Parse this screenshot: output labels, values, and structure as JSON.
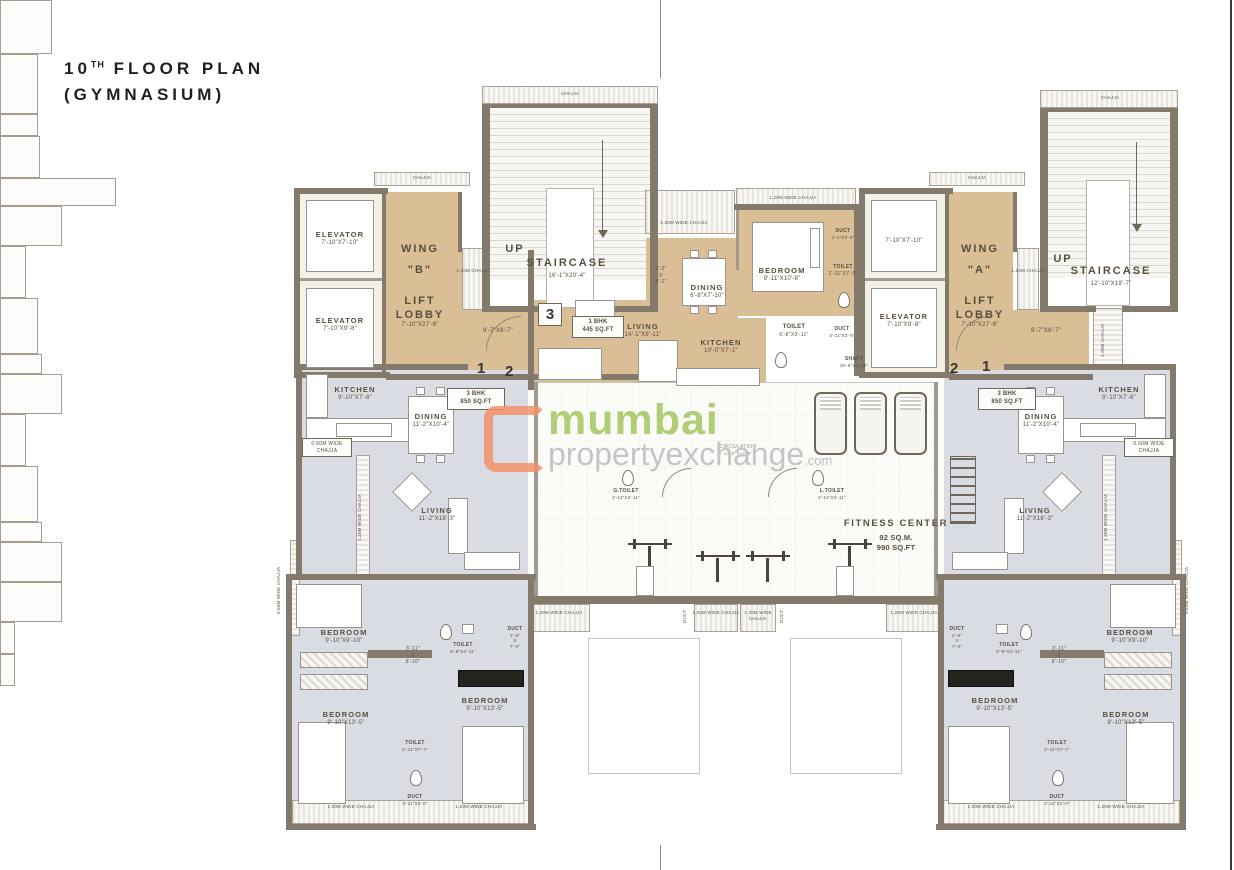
{
  "page": {
    "title_num": "10",
    "title_sup": "TH",
    "title_rest": " FLOOR PLAN",
    "title_line2": "(GYMNASIUM)"
  },
  "watermark": {
    "brand_green": "mumbai",
    "brand_gray": "propertyexchange",
    "brand_suffix": ".com"
  },
  "colors": {
    "lobby_tan": "#d9be96",
    "room_gray": "#d9dde3",
    "wall": "#837a6b",
    "brand_green": "#a5c65f",
    "brand_orange": "#f2916b",
    "brand_gray": "#bcbcbc"
  },
  "common": {
    "chajja": "CHAJJA",
    "chajja_120m": "1.20M CHAJJA",
    "chajja_120_wide": "1.20M WIDE CHAJJA",
    "chajja_060_wide": "0.60M WIDE CHAJJA",
    "duct": "DUCT",
    "toilet": "TOILET",
    "bedroom": "BEDROOM",
    "elevator": "ELEVATOR",
    "kitchen": "KITCHEN",
    "dining": "DINING",
    "living": "LIVING",
    "up": "UP",
    "staircase": "STAIRCASE",
    "lift_lobby": "LIFT LOBBY",
    "shaft": "SHAFT"
  },
  "wing_b": {
    "name1": "WING",
    "name2": "\"B\"",
    "lobby_dims": "7'-10\"X27'-6\"",
    "corridor_dims": "9'-7\"X6'-7\"",
    "elev1_dims": "7'-10\"X7'-10\"",
    "elev2_dims": "7'-10\"X9'-8\"",
    "stair_dims": "16'-1\"X20'-4\"",
    "door_a": "1",
    "door_b": "2"
  },
  "wing_a": {
    "name1": "WING",
    "name2": "\"A\"",
    "lobby_dims": "7'-10\"X27'-6\"",
    "corridor_dims": "9'-7\"X6'-7\"",
    "elev1_dims": "7'-10\"X7'-10\"",
    "elev2_dims": "7'-10\"X9'-8\"",
    "stair_dims": "12'-10\"X19'-7\"",
    "door_a": "2",
    "door_b": "1"
  },
  "unit1": {
    "no": "3",
    "type": "1 BHK",
    "area": "445 SQ.FT",
    "living": "14'-1\"X9'-11\"",
    "dining": "6'-8\"X7'-10\"",
    "pass1": "3'-2\"",
    "pass2": "X",
    "pass3": "8'-1\"",
    "bedroom": "9'-11\"X10'-8\"",
    "kitchen": "10'-0\"X7'-1\"",
    "toilet1": "6'-8\"X3'-11\"",
    "toilet2": "2'-11\"X7'-5\"",
    "duct1": "2'-1\"X2'-9\"",
    "duct2": "3'-11\"X3'-9\"",
    "shaft_dims": "15'-6\"X2'-10\""
  },
  "unit3": {
    "type": "3 BHK",
    "area": "850 SQ.FT",
    "kitchen": "9'-10\"X7'-6\"",
    "dining": "11'-2\"X10'-4\"",
    "living": "11'-2\"X18'-3\"",
    "bed1": "9'-10\"X9'-10\"",
    "bed2": "9'-10\"X13'-5\"",
    "bed3": "9'-10\"X13'-5\"",
    "toilet1": "6'-9\"X4'-11\"",
    "toilet2": "2'-11\"X7'-7\"",
    "duct1a": "2'-8\"",
    "duct1b": "X",
    "duct1c": "7'-3\"",
    "duct2": "3'-11\"X2'-0\"",
    "pass1": "3'-11\"",
    "pass2": "X",
    "pass3": "8'-10\""
  },
  "gym": {
    "name": "FITNESS CENTER",
    "area_m": "92 SQ.M.",
    "area_ft": "990 SQ.FT",
    "gt": "G.TOILET",
    "gt_dims": "4'-11\"X2'-11\"",
    "lt": "L.TOILET",
    "lt_dims": "4'-11\"X2'-11\"",
    "circ": "CIRCULATION",
    "circ_dims": "14'-9\"X12'-8\""
  }
}
